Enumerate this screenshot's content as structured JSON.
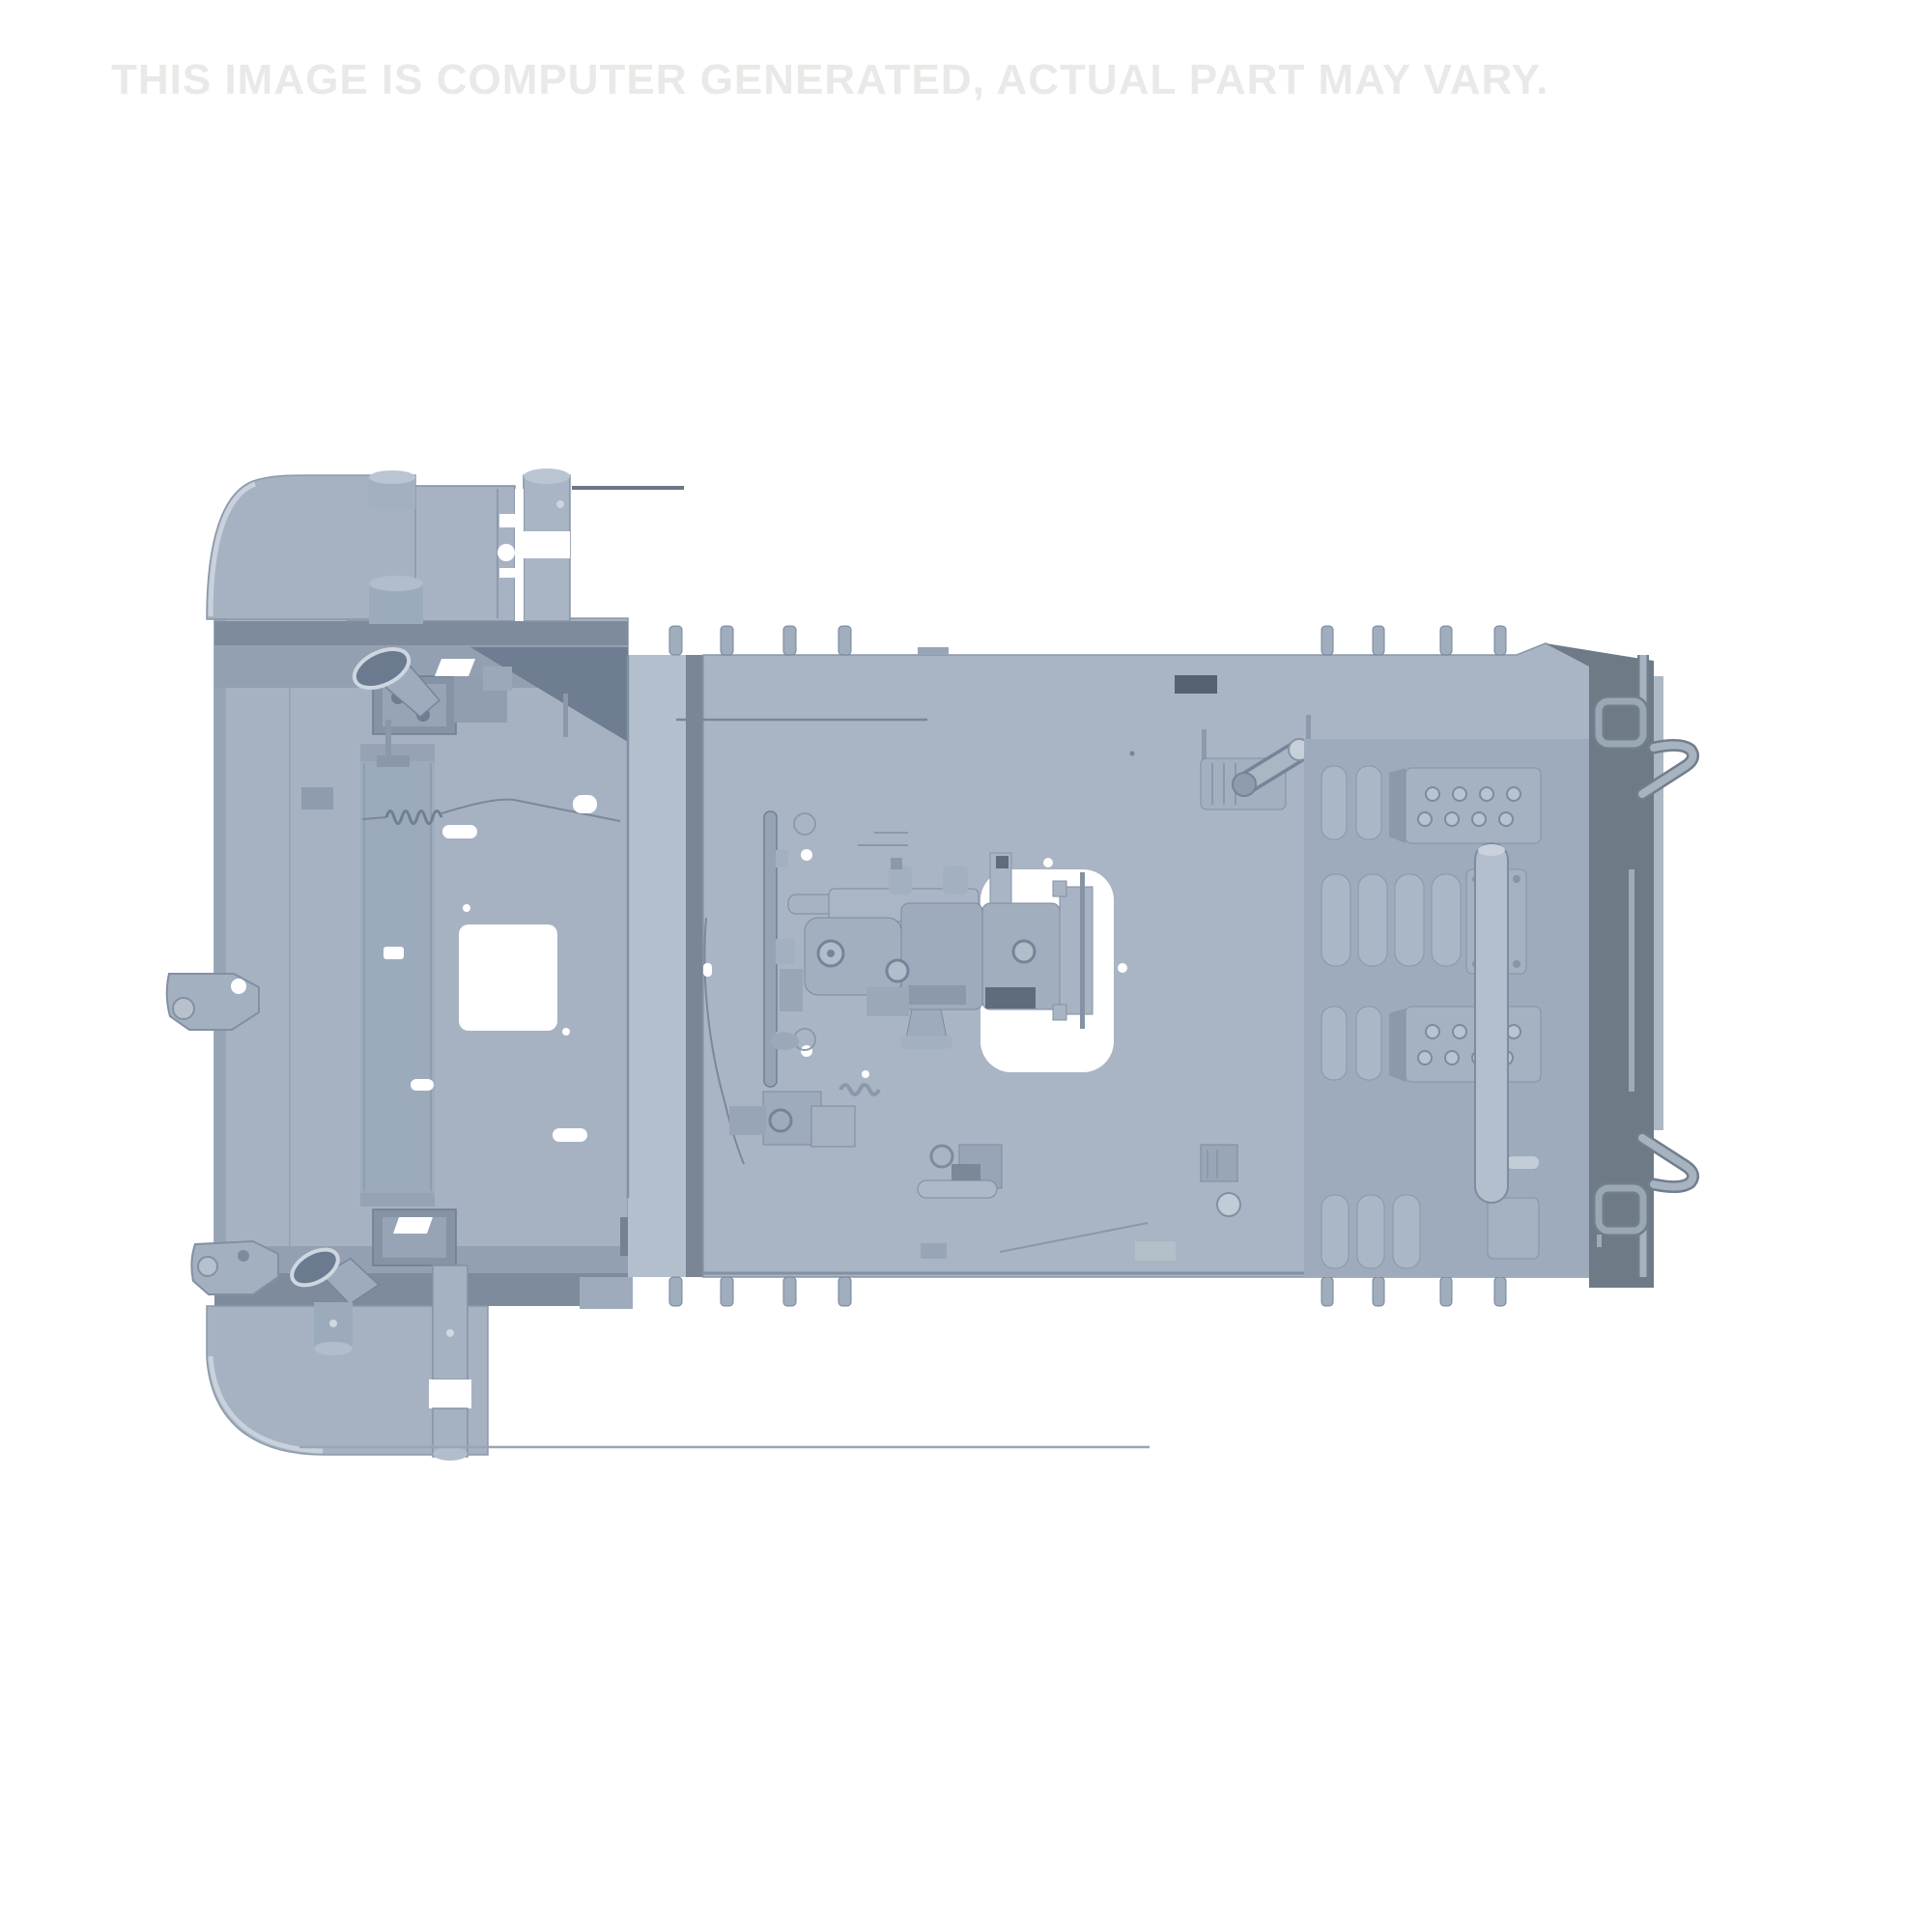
{
  "watermark": {
    "text": "THIS IMAGE IS COMPUTER GENERATED, ACTUAL PART MAY VARY.",
    "color": "#e9e9e7"
  },
  "scene": {
    "background_color": "#ffffff",
    "description": "Computer-generated CAD render of a utility tractor chassis / frame deck assembly seen from above: front fender and radiator support frame on the left, large flat operator deck plate in the center with engine-transmission assembly and rounded access cutout, ribbed footrest pads, bolt plates and frame hooks on the right.",
    "palette": {
      "body": "#a9b5c4",
      "plate": "#a6b2c2",
      "body_light": "#b3bfcc",
      "body_lighter": "#c9d2dc",
      "body_dark": "#93a0b1",
      "shade": "#7e8b9c",
      "shade_dark": "#6e7d91",
      "channel": "#7b8695",
      "side_panel": "#6f7a87",
      "recess": "#9dabbd",
      "slot_dark": "#566170",
      "machine_gray": "#9dabbc",
      "cutout": "#ffffff",
      "outline": "#8290a2"
    },
    "parts": [
      "front-fender-top",
      "front-fender-bottom",
      "radiator-support-plate",
      "radiator-core",
      "muffler-box-top",
      "muffler-box-bottom",
      "intake-elbow-top",
      "intake-elbow-bottom",
      "support-cylinder-pair-top",
      "support-cylinder-pair-bottom",
      "mounting-pins",
      "main-deck-plate",
      "deck-access-cutout",
      "vent-slot",
      "engine-transmission-assembly",
      "steering-support-disc",
      "control-lever",
      "pedal-assembly",
      "ball-knob-lever",
      "footrest-pad-rows",
      "bolt-plates",
      "lift-cylinder",
      "side-panel",
      "frame-hook-top",
      "frame-hook-bottom",
      "tow-bracket-mid",
      "tow-bracket-bottom"
    ]
  }
}
